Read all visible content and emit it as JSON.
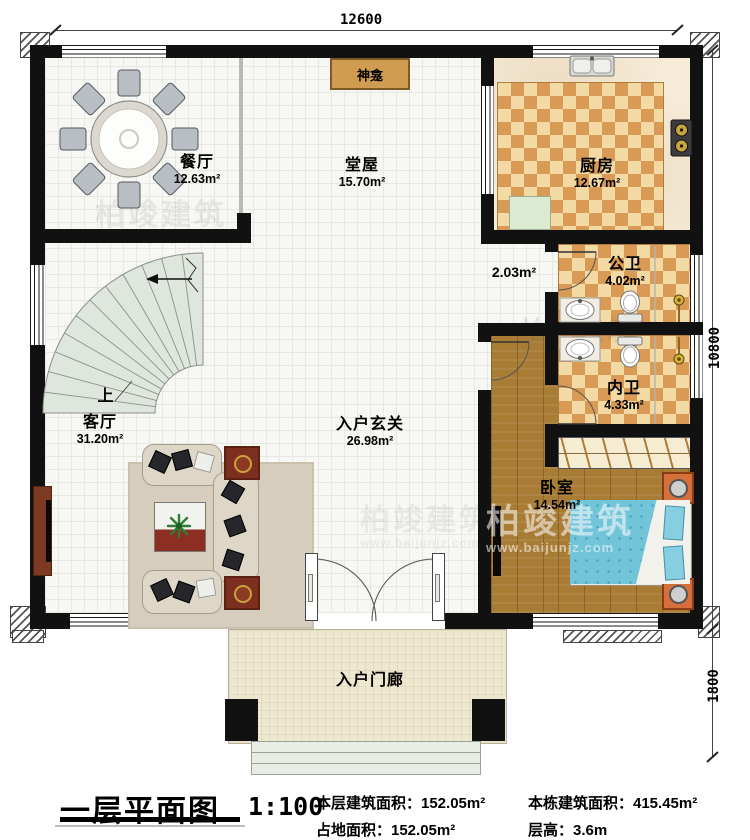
{
  "watermark": {
    "brand": "柏竣建筑",
    "url": "www.baijunjz.com"
  },
  "dimensions": {
    "width_top": "12600",
    "height_main": "10800",
    "height_porch": "1800"
  },
  "rooms": {
    "dining": {
      "name": "餐厅",
      "area": "12.63m²"
    },
    "hall": {
      "name": "堂屋",
      "area": "15.70m²"
    },
    "kitchen": {
      "name": "厨房",
      "area": "12.67m²"
    },
    "corridor": {
      "area": "2.03m²"
    },
    "public_bath": {
      "name": "公卫",
      "area": "4.02m²"
    },
    "inner_bath": {
      "name": "内卫",
      "area": "4.33m²"
    },
    "bedroom": {
      "name": "卧室",
      "area": "14.54m²"
    },
    "living": {
      "name": "客厅",
      "area": "31.20m²"
    },
    "foyer": {
      "name": "入户玄关",
      "area": "26.98m²"
    },
    "porch": {
      "name": "入户门廊"
    },
    "shrine": {
      "name": "神龛"
    },
    "stairs": {
      "up_label": "上"
    }
  },
  "title_block": {
    "title": "一层平面图",
    "scale": "1:100",
    "floor_area": "本层建筑面积：152.05m²",
    "land_area": "占地面积：152.05m²",
    "total_area": "本栋建筑面积：415.45m²",
    "floor_height": "层高：3.6m"
  },
  "colors": {
    "wall": "#111111",
    "checker_dark": "#d89a55",
    "checker_light": "#f3d9a4",
    "wood_floor": "#a97c35",
    "bed": "#72c4d8",
    "stairs": "#dfe6dd",
    "furniture_wood": "#7c2f1f"
  }
}
